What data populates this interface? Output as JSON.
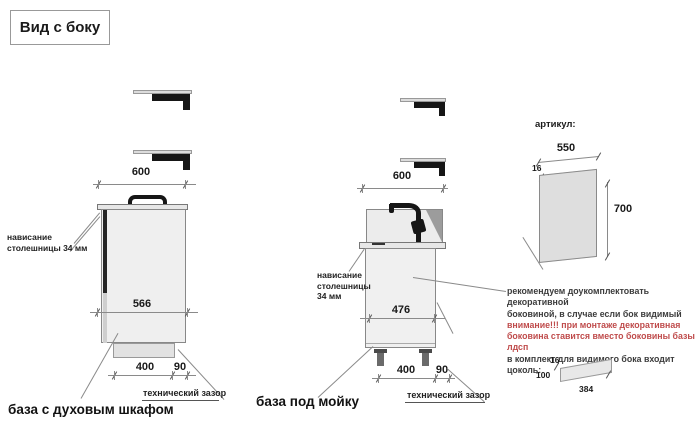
{
  "title": "Вид с боку",
  "colors": {
    "attention_red": "#bf4b4b"
  },
  "oven_view": {
    "dim_top_width": "600",
    "dim_body_depth": "566",
    "dim_front": "400",
    "dim_gap": "90",
    "overhang_line1": "нависание",
    "overhang_line2": "столешницы 34 мм",
    "gap_label": "технический зазор",
    "caption": "база с духовым шкафом"
  },
  "sink_view": {
    "dim_top_width": "600",
    "dim_body_depth": "476",
    "dim_front": "400",
    "dim_gap": "90",
    "overhang_line1": "нависание",
    "overhang_line2": "столешницы",
    "overhang_line3": "34 мм",
    "gap_label": "технический зазор",
    "caption": "база под мойку"
  },
  "side_panel": {
    "article_label": "артикул:",
    "dim_width": "550",
    "dim_thickness": "16",
    "dim_height": "700",
    "note": {
      "line1": "рекомендуем доукомплектовать декоративной",
      "line2": "боковиной, в случае если бок видимый",
      "line3": "внимание!!! при монтаже декоративная",
      "line4": "боковина ставится вместо боковины базы лдсп",
      "line5": "в комплект для видимого бока входит цоколь:"
    },
    "plinth": {
      "dim_thickness": "16",
      "dim_height": "100",
      "dim_length": "384"
    }
  }
}
